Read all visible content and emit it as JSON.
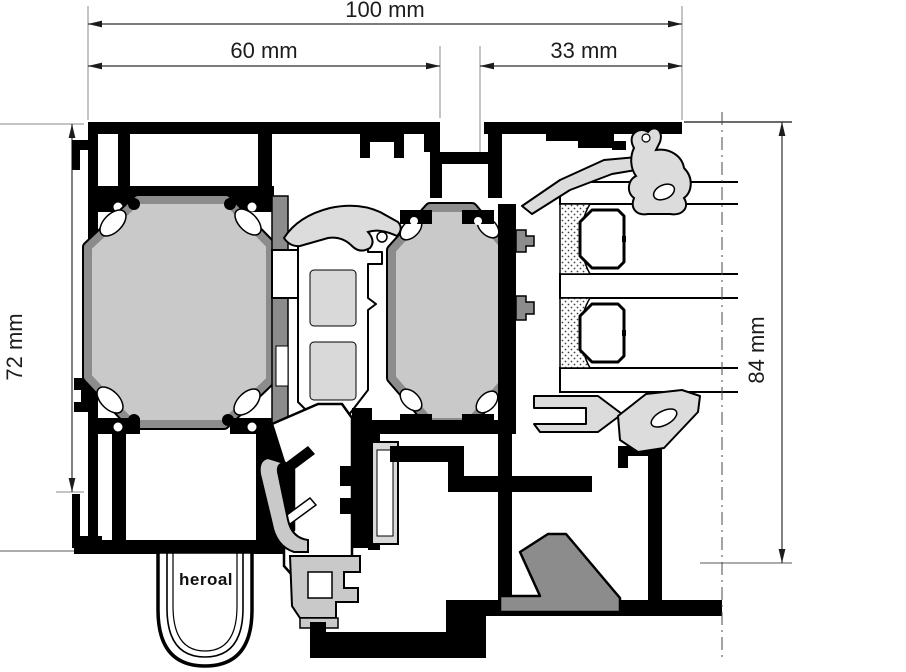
{
  "drawing": {
    "type": "profile-cross-section",
    "brand_label": "heroal",
    "dimensions": {
      "total_width": "100 mm",
      "frame_section_width": "60 mm",
      "sash_face_width": "33 mm",
      "frame_depth": "72 mm",
      "sash_overall_depth": "84 mm"
    },
    "palette": {
      "outline": "#000000",
      "insulation_fill": "#c9c9c9",
      "thermal_web": "#8c8c8c",
      "gasket": "#dcdcdc",
      "hardware_plate": "#d9d9d9",
      "dimension_line": "#2e2e2e",
      "background": "#ffffff"
    },
    "glazing": {
      "pane_count": 3,
      "spacer_count": 2
    }
  }
}
